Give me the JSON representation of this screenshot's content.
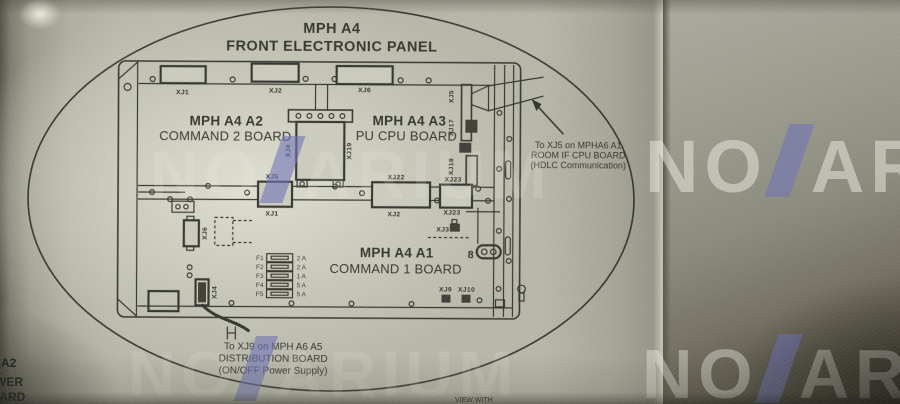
{
  "colors": {
    "ink": "#30302a",
    "paper": "#b8b8aa",
    "wm-slash": "#6f74b8"
  },
  "page": {
    "title_line1": "MPH A4",
    "title_line2": "FRONT ELECTRONIC PANEL"
  },
  "boards": {
    "command2_line1": "MPH A4 A2",
    "command2_line2": "COMMAND 2 BOARD",
    "cpu_line1": "MPH A4 A3",
    "cpu_line2": "PU CPU BOARD",
    "command1_line1": "MPH A4 A1",
    "command1_line2": "COMMAND 1 BOARD"
  },
  "connectors": {
    "top_xj1": "XJ1",
    "top_xj2": "XJ2",
    "top_xj6": "XJ6",
    "center_xj4": "XJ4",
    "center_xj19": "XJ19",
    "right_xj5": "XJ5",
    "right_xj17": "XJ17",
    "right_xj18": "XJ18",
    "mid_xj5": "XJ5",
    "mid_xj1": "XJ1",
    "mid_xj22": "XJ22",
    "mid_xj2": "XJ2",
    "mid_xj23_top": "XJ23",
    "mid_xj23_bottom": "XJ23",
    "xj3": "XJ3",
    "left_xj6": "XJ6",
    "left_xj4": "XJ4",
    "bottom_xj9": "XJ9",
    "bottom_xj10": "XJ10",
    "label_8": "8"
  },
  "fuses": [
    {
      "name": "F1",
      "rating": "2 A"
    },
    {
      "name": "F2",
      "rating": "2 A"
    },
    {
      "name": "F3",
      "rating": "1 A"
    },
    {
      "name": "F4",
      "rating": "5 A"
    },
    {
      "name": "F5",
      "rating": "5 A"
    }
  ],
  "callouts": {
    "right_line1": "To XJ5 on MPHA6 A1",
    "right_line2": "ROOM IF CPU BOARD",
    "right_line3": "(HDLC Communication)",
    "bottom_line1": "To XJ9 on MPH A6 A5",
    "bottom_line2": "DISTRIBUTION BOARD",
    "bottom_line3": "(ON/OFF Power Supply)"
  },
  "fragments": {
    "left_line1": "A2",
    "left_line2": "WER",
    "left_line3": "OARD",
    "bottom_caption": "VIEW WITH"
  },
  "watermark": {
    "pre": "NO",
    "post_long": "ARIUM",
    "post_short": "AR"
  }
}
